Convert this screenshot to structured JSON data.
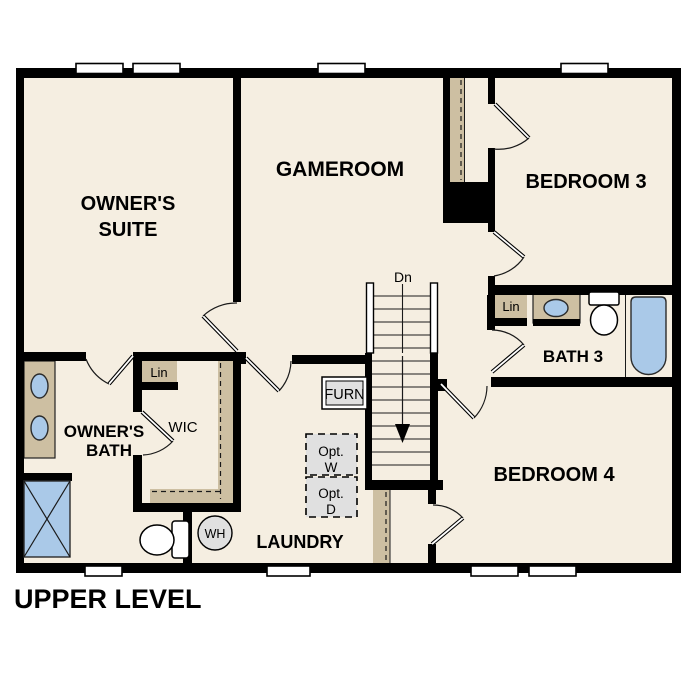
{
  "title": "UPPER LEVEL",
  "rooms": {
    "owners_suite": {
      "line1": "OWNER'S",
      "line2": "SUITE"
    },
    "gameroom": {
      "label": "GAMEROOM"
    },
    "bedroom3": {
      "label": "BEDROOM 3"
    },
    "bath3": {
      "label": "BATH 3"
    },
    "bedroom4": {
      "label": "BEDROOM 4"
    },
    "owners_bath": {
      "line1": "OWNER'S",
      "line2": "BATH"
    },
    "wic": {
      "label": "WIC"
    },
    "laundry": {
      "label": "LAUNDRY"
    }
  },
  "annotations": {
    "stairs_direction": "Dn",
    "linen_bath3": "Lin",
    "linen_wic": "Lin",
    "furnace": "FURN",
    "optional_washer": {
      "line1": "Opt.",
      "line2": "W"
    },
    "optional_dryer": {
      "line1": "Opt.",
      "line2": "D"
    },
    "water_heater": "WH"
  },
  "colors": {
    "background": "#ffffff",
    "floor": "#f5eee1",
    "walls": "#000000",
    "cabinetry_tan": "#cdbfa2",
    "fixture_blue": "#aac9e8",
    "appliance_gray": "#e0e0e0",
    "text": "#000000"
  }
}
